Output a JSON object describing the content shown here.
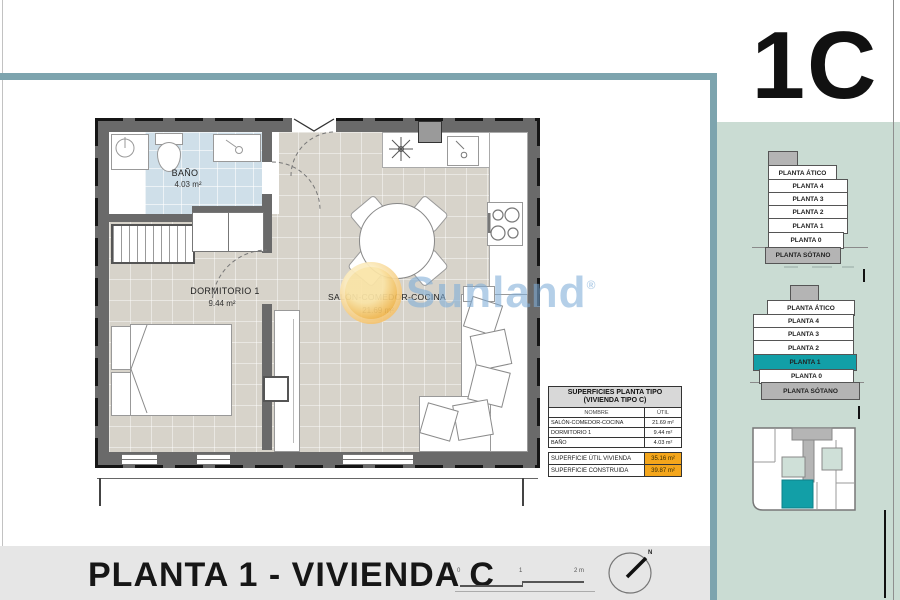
{
  "unit_label": "1C",
  "plan": {
    "rooms": {
      "bano": {
        "name": "BAÑO",
        "area": "4.03 m²"
      },
      "dormitorio": {
        "name": "DORMITORIO 1",
        "area": "9.44 m²"
      },
      "salon": {
        "name": "SALÓN-COMEDOR-COCINA",
        "area": "21.69 m²"
      }
    }
  },
  "surfaces_table": {
    "title_line1": "SUPERFICIES PLANTA TIPO",
    "title_line2": "(VIVIENDA TIPO C)",
    "headers": {
      "name": "NOMBRE",
      "util": "ÚTIL"
    },
    "rows": [
      {
        "name": "SALÓN-COMEDOR-COCINA",
        "util": "21.69 m²"
      },
      {
        "name": "DORMITORIO 1",
        "util": "9.44 m²"
      },
      {
        "name": "BAÑO",
        "util": "4.03 m²"
      }
    ],
    "totals": [
      {
        "name": "SUPERFICIE ÚTIL VIVIENDA",
        "value": "35.16 m²"
      },
      {
        "name": "SUPERFICIE CONSTRUIDA",
        "value": "39.87 m²"
      }
    ]
  },
  "sidebar": {
    "stack_top": {
      "levels": [
        "PLANTA ÁTICO",
        "PLANTA 4",
        "PLANTA 3",
        "PLANTA 2",
        "PLANTA 1",
        "PLANTA 0",
        "PLANTA SÓTANO"
      ]
    },
    "stack_middle": {
      "levels": [
        "PLANTA ÁTICO",
        "PLANTA 4",
        "PLANTA 3",
        "PLANTA 2",
        "PLANTA 1",
        "PLANTA 0",
        "PLANTA SÓTANO"
      ],
      "highlighted_level": "PLANTA 1"
    }
  },
  "footer": {
    "title": "PLANTA 1 - VIVIENDA C",
    "scale_labels": {
      "start": "0",
      "mid": "1",
      "end": "2 m"
    },
    "north_label": "N"
  },
  "watermark": {
    "brand": "Sunland",
    "registered": "®"
  },
  "colors": {
    "accent_teal": "#129fa7",
    "frame_teal": "#7da4ae",
    "sidebar_green": "#cadcd3",
    "highlight_orange": "#f4a61c",
    "bath_blue": "#cfdfe9",
    "wall_gray": "#6a6a6a"
  }
}
